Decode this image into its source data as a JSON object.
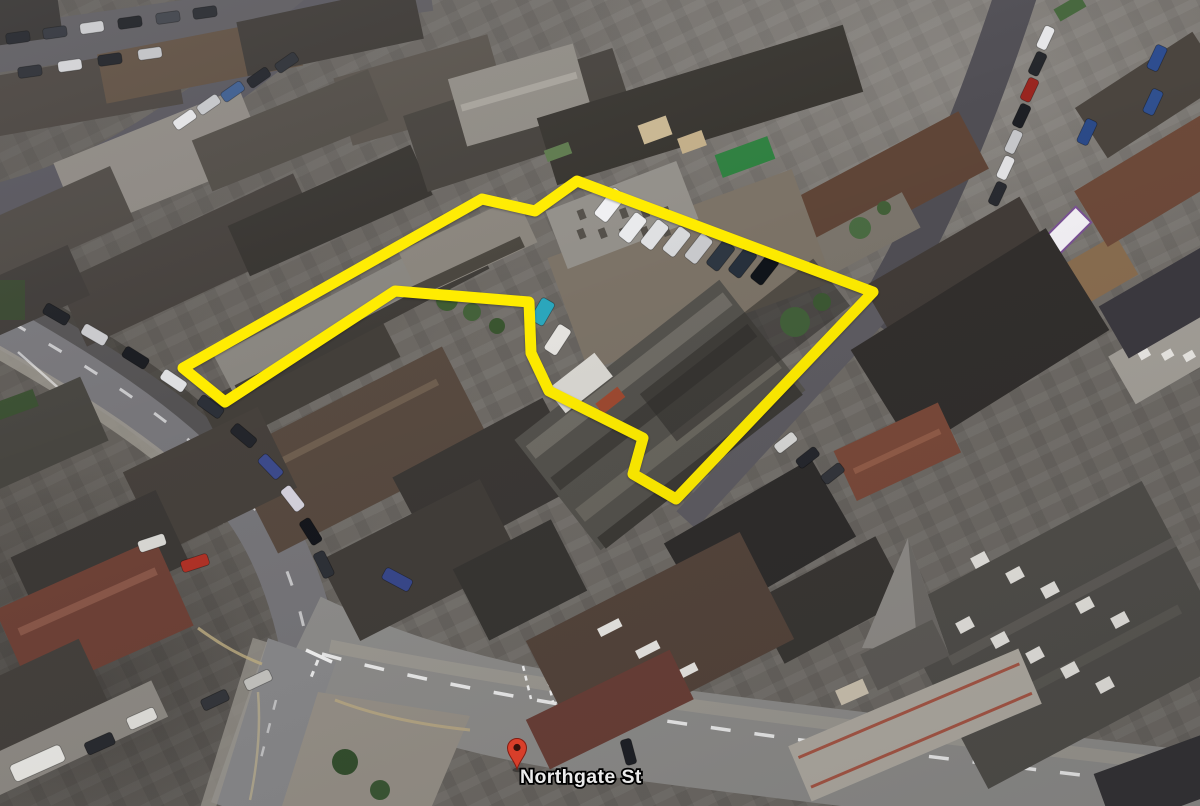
{
  "map": {
    "street_label": {
      "text": "Northgate St",
      "text_color": "#ffffff",
      "outline_color": "#000000"
    },
    "pin": {
      "fill": "#e8432d",
      "border": "#8c1d12",
      "hole": "#3a120b"
    },
    "boundary": {
      "stroke": "#ffec00",
      "stroke_width": 11,
      "points": [
        [
          183,
          368
        ],
        [
          482,
          199
        ],
        [
          535,
          211
        ],
        [
          577,
          181
        ],
        [
          873,
          292
        ],
        [
          676,
          499
        ],
        [
          633,
          474
        ],
        [
          643,
          438
        ],
        [
          549,
          391
        ],
        [
          531,
          353
        ],
        [
          529,
          302
        ],
        [
          395,
          291
        ],
        [
          225,
          402
        ]
      ]
    }
  }
}
